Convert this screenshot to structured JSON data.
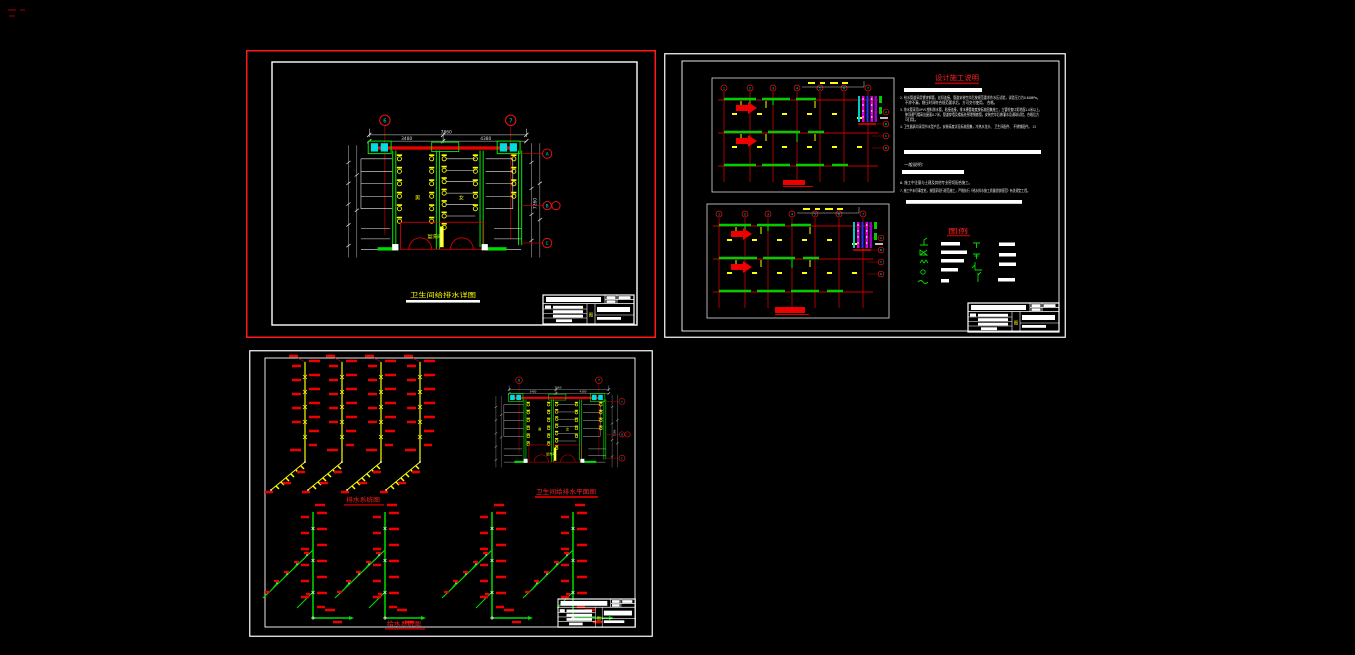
{
  "canvas": {
    "width": 1355,
    "height": 655,
    "background": "#000000"
  },
  "palette": {
    "red": "#ee0000",
    "green": "#00cc00",
    "yellow": "#ffff00",
    "cyan": "#00dddd",
    "white": "#ffffff",
    "magenta": "#dd00dd",
    "blue": "#2233ff",
    "dark_red": "#990000",
    "selection_red": "#ff1a1a"
  },
  "sheet1": {
    "plan_title": "卫生间给排水详图",
    "dims": {
      "total": "7860",
      "seg_left": "3480",
      "seg_right": "4380",
      "right_total": "7260"
    },
    "axis": {
      "top": [
        "6",
        "7"
      ],
      "right": [
        "A",
        "B",
        "C"
      ]
    },
    "rooms": {
      "left": "男",
      "right": "女",
      "center": "盥洗间"
    }
  },
  "sheet2": {
    "axis_top": [
      "1",
      "2",
      "3",
      "4",
      "5",
      "6",
      "7"
    ],
    "axis_right": [
      "A",
      "B",
      "C",
      "D"
    ],
    "notes": {
      "title": "设计施工说明",
      "lines": [
        "2. 给水管道采用镀锌钢管，丝扣连接，管道安装完毕后按规范要求作水压试验，试验压力为0.60MPa，",
        "不渗不漏，稳压时间符合规范要求后，方可交付使用。 合格。",
        "3. 排水管采用UPVC塑料排水管，粘接连接，排水横管坡度按标准图集施工，立管检查口距地面1.0米以上，",
        "伸顶通气帽高出屋面0.7米，管道穿墙及楼板处预埋钢套管，安装完毕后做灌水及通球试验，合格后方",
        "可用。",
        "4. 卫生器具均采用节水型产品，安装高度详见标准图集，冷热水龙头、 卫生间配件、 不锈钢配件。 13"
      ],
      "general_label": "一般说明：",
      "lines2": [
        "6. 施工中注意与土建及其他专业密切配合施工。",
        "7. 施工中未尽事宜处，按国家现行规范施工，严格执行《给水排水施工质量验收规范》有关规定工程。"
      ]
    },
    "legend": {
      "title": "图例"
    }
  },
  "sheet3": {
    "titles": {
      "waste_riser": "排水系统图",
      "plan": "卫生间给排水平面图",
      "supply_riser": "给水系统图"
    }
  },
  "title_block": {
    "glyph": "图"
  }
}
